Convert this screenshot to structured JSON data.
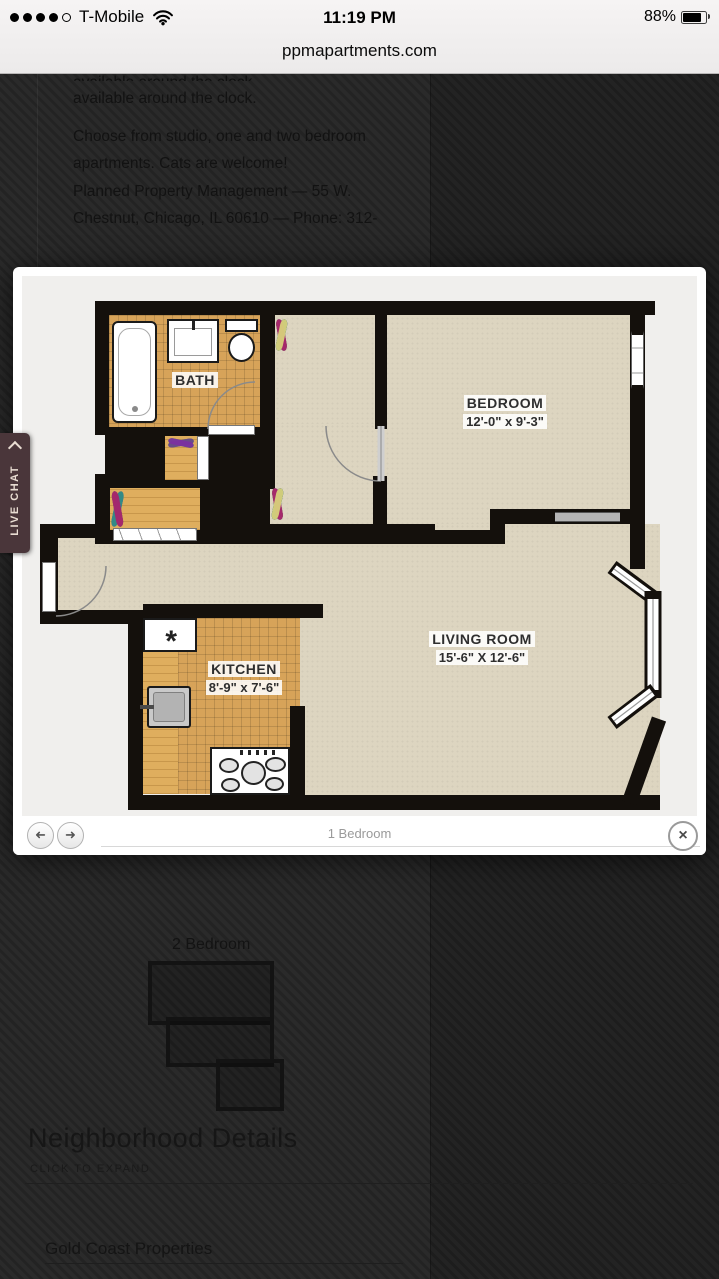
{
  "status_bar": {
    "carrier": "T-Mobile",
    "time": "11:19 PM",
    "battery": "88%",
    "signal": {
      "filled": 4,
      "total": 5
    },
    "icons": {
      "wifi": "wifi-icon",
      "battery": "battery-icon",
      "signal": "signal-dots"
    }
  },
  "url_bar": {
    "domain": "ppmapartments.com"
  },
  "live_chat": {
    "label": "LIVE CHAT",
    "icon": "chevron-icon"
  },
  "page_background": {
    "paragraph_1": "available around the clock.",
    "paragraph_2": "Choose from studio, one and two bedroom apartments. Cats are welcome!",
    "paragraph_3": "Planned Property Management — 55 W. Chestnut, Chicago, IL 60610 — Phone: 312-",
    "thumb_label": "2 Bedroom",
    "section_title": "Neighborhood Details",
    "section_subtitle": "CLICK TO EXPAND",
    "link_text": "Gold Coast Properties"
  },
  "lightbox": {
    "caption": "1 Bedroom",
    "prev_symbol": "➜",
    "next_symbol": "➜",
    "close_symbol": "×",
    "floor_plan": {
      "rooms": {
        "bath": {
          "name": "BATH"
        },
        "bedroom": {
          "name": "BEDROOM",
          "dims": "12'-0\" x 9'-3\""
        },
        "kitchen": {
          "name": "KITCHEN",
          "dims": "8'-9\" x 7'-6\""
        },
        "living": {
          "name": "LIVING ROOM",
          "dims": "15'-6\" X 12'-6\""
        }
      },
      "fixtures": {
        "ceiling_symbol": "*"
      },
      "colors": {
        "wall": "#14100c",
        "carpet": "#ddd5c0",
        "tile": "#d7a359",
        "wood": "#dfae5e",
        "plan_bg": "#f0efed"
      },
      "hanger_colors": [
        "#3f6fbe",
        "#3cb54b",
        "#6a4a85",
        "#7b2fa0",
        "#7a8b2f",
        "#2f8f85",
        "#a8236f",
        "#d8d07a"
      ]
    }
  }
}
